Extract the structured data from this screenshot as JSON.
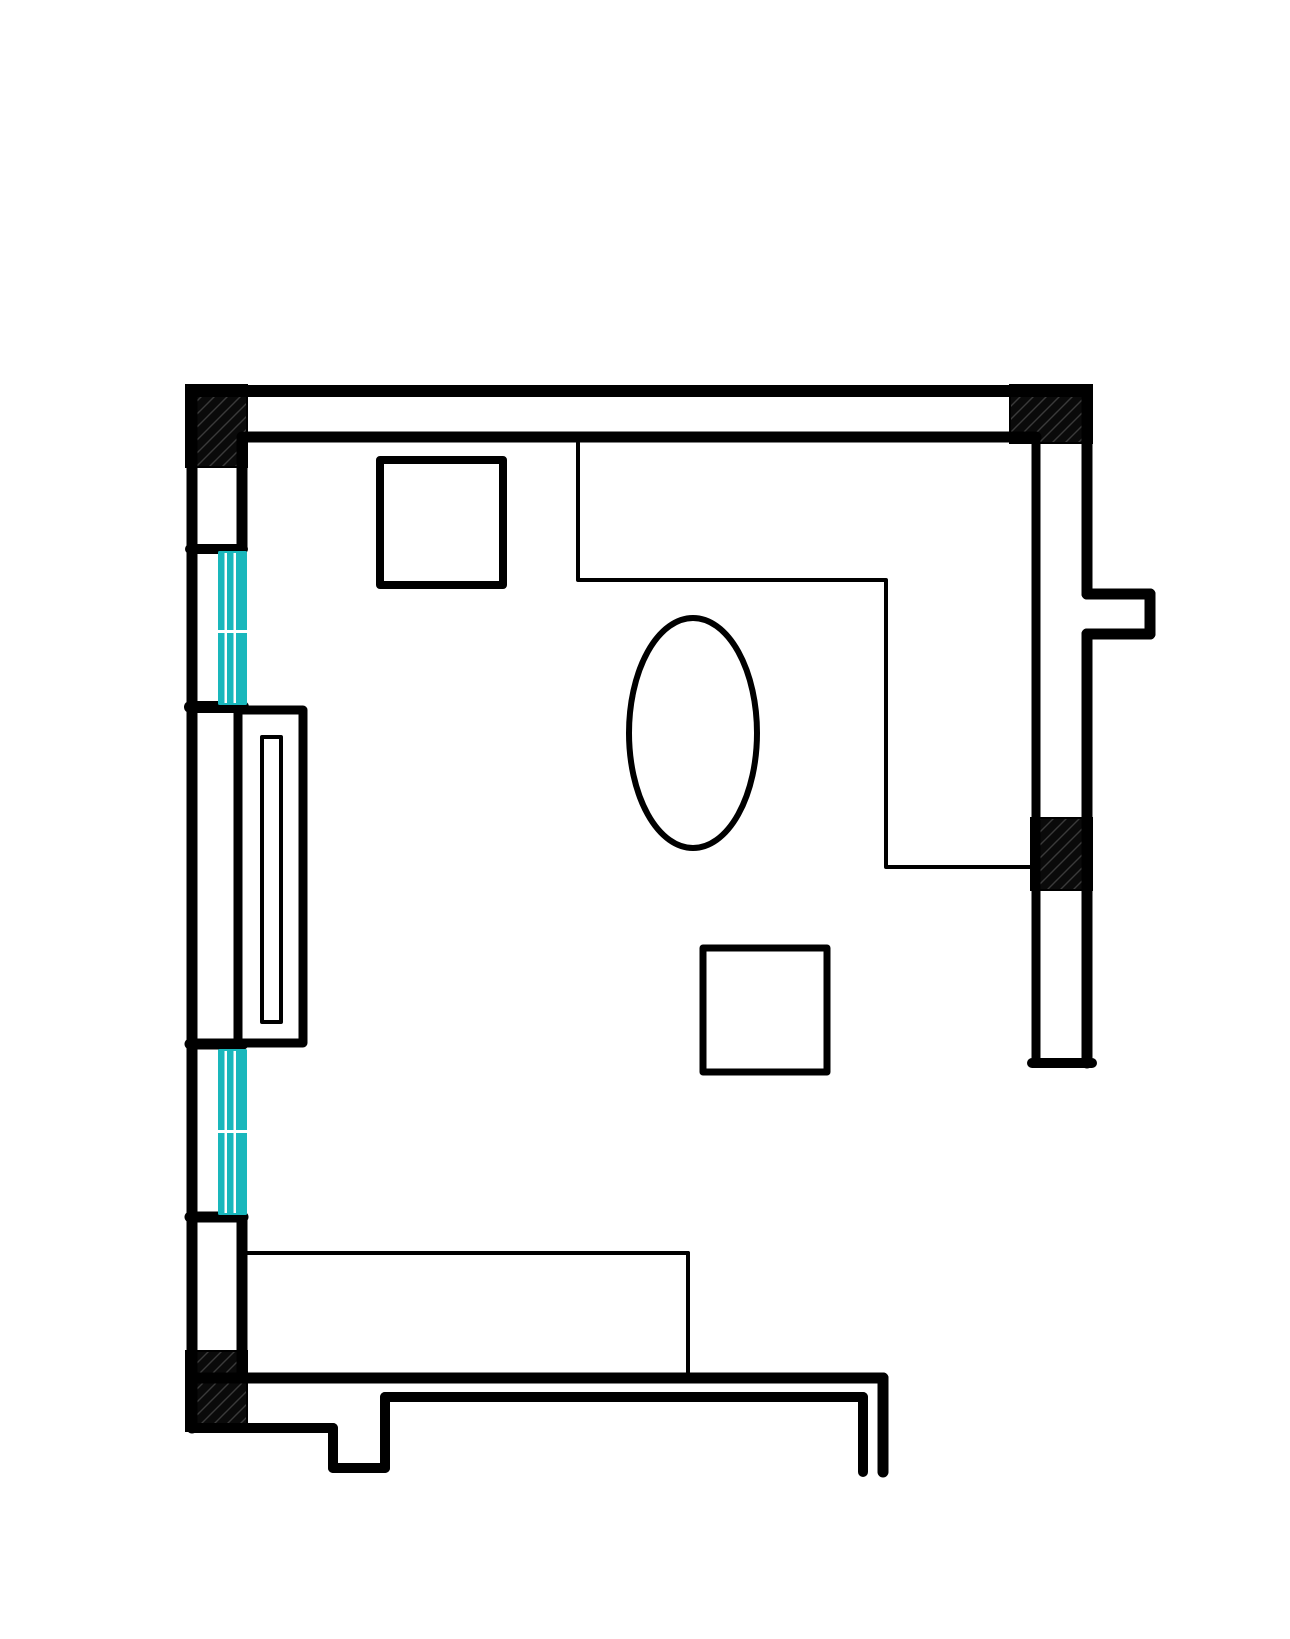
{
  "page": {
    "title": "Room floor plan drawing"
  },
  "canvas": {
    "width": 1290,
    "height": 1639,
    "background": "#ffffff"
  },
  "colors": {
    "wall": "#000000",
    "window_glass": "#19b7bc",
    "window_mullion": "#ffffff",
    "hatch_fill": "#0a0a0a",
    "hatch_stroke": "#3a3a3a",
    "furniture_fill": "#ffffff"
  },
  "walls": {
    "lines": [
      {
        "name": "top-wall-outer",
        "x1": 192,
        "y1": 391,
        "x2": 1087,
        "y2": 391,
        "w": 12
      },
      {
        "name": "top-wall-inner",
        "x1": 247,
        "y1": 437,
        "x2": 1036,
        "y2": 437,
        "w": 11
      },
      {
        "name": "left-wall-outer",
        "x1": 192,
        "y1": 391,
        "x2": 192,
        "y2": 1428,
        "w": 11
      },
      {
        "name": "left-wall-inner-upper",
        "x1": 242,
        "y1": 437,
        "x2": 242,
        "y2": 549,
        "w": 11
      },
      {
        "name": "left-wall-cap-above-window-1",
        "x1": 190,
        "y1": 549,
        "x2": 243,
        "y2": 549,
        "w": 10
      },
      {
        "name": "left-wall-cap-below-window-1",
        "x1": 190,
        "y1": 707,
        "x2": 243,
        "y2": 707,
        "w": 12
      },
      {
        "name": "left-wall-inner-middle",
        "x1": 242,
        "y1": 707,
        "x2": 242,
        "y2": 1044,
        "w": 11
      },
      {
        "name": "left-wall-cap-above-window-2",
        "x1": 190,
        "y1": 1044,
        "x2": 243,
        "y2": 1044,
        "w": 11
      },
      {
        "name": "left-wall-cap-below-window-2",
        "x1": 190,
        "y1": 1217,
        "x2": 243,
        "y2": 1217,
        "w": 11
      },
      {
        "name": "left-wall-inner-lower",
        "x1": 242,
        "y1": 1217,
        "x2": 242,
        "y2": 1378,
        "w": 11
      },
      {
        "name": "right-wall-inner",
        "x1": 1036,
        "y1": 437,
        "x2": 1036,
        "y2": 1063,
        "w": 9
      },
      {
        "name": "right-wall-outer-upper",
        "x1": 1087,
        "y1": 391,
        "x2": 1087,
        "y2": 594,
        "w": 11
      },
      {
        "name": "right-wall-outer-lower",
        "x1": 1087,
        "y1": 634,
        "x2": 1087,
        "y2": 1063,
        "w": 11
      },
      {
        "name": "right-wall-end-cap",
        "x1": 1032,
        "y1": 1063,
        "x2": 1092,
        "y2": 1063,
        "w": 10
      },
      {
        "name": "right-pier-top",
        "x1": 1087,
        "y1": 594,
        "x2": 1150,
        "y2": 594,
        "w": 11
      },
      {
        "name": "right-pier-right",
        "x1": 1150,
        "y1": 594,
        "x2": 1150,
        "y2": 634,
        "w": 11
      },
      {
        "name": "right-pier-bottom",
        "x1": 1150,
        "y1": 634,
        "x2": 1087,
        "y2": 634,
        "w": 11
      },
      {
        "name": "bottom-wall-top",
        "x1": 192,
        "y1": 1378,
        "x2": 883,
        "y2": 1378,
        "w": 11
      },
      {
        "name": "bottom-wall-inner",
        "x1": 385,
        "y1": 1397,
        "x2": 863,
        "y2": 1397,
        "w": 10
      },
      {
        "name": "bottom-wall-outer-left",
        "x1": 192,
        "y1": 1428,
        "x2": 333,
        "y2": 1428,
        "w": 10
      },
      {
        "name": "bottom-notch-left",
        "x1": 333,
        "y1": 1428,
        "x2": 333,
        "y2": 1468,
        "w": 10
      },
      {
        "name": "bottom-notch-bottom",
        "x1": 333,
        "y1": 1468,
        "x2": 385,
        "y2": 1468,
        "w": 10
      },
      {
        "name": "bottom-notch-right",
        "x1": 385,
        "y1": 1468,
        "x2": 385,
        "y2": 1397,
        "w": 10
      },
      {
        "name": "bottom-right-stub-outer",
        "x1": 883,
        "y1": 1378,
        "x2": 883,
        "y2": 1472,
        "w": 11
      },
      {
        "name": "bottom-right-stub-inner",
        "x1": 863,
        "y1": 1397,
        "x2": 863,
        "y2": 1472,
        "w": 10
      }
    ]
  },
  "hatch_blocks": [
    {
      "name": "corner-block-top-left",
      "x": 186,
      "y": 385,
      "w": 61,
      "h": 82
    },
    {
      "name": "corner-block-top-right",
      "x": 1010,
      "y": 385,
      "w": 82,
      "h": 58
    },
    {
      "name": "pier-block-right-wall",
      "x": 1031,
      "y": 818,
      "w": 61,
      "h": 72
    },
    {
      "name": "corner-block-bottom-left",
      "x": 186,
      "y": 1351,
      "w": 61,
      "h": 80
    }
  ],
  "windows": [
    {
      "name": "window-1",
      "x": 218,
      "y": 551,
      "w": 29,
      "h": 154,
      "seam_y": 630,
      "mullions": [
        224.5,
        233.5
      ],
      "mullion_w": 2.5,
      "seam_h": 3
    },
    {
      "name": "window-2",
      "x": 218,
      "y": 1049,
      "w": 29,
      "h": 166,
      "seam_y": 1130,
      "mullions": [
        224.5,
        233.5
      ],
      "mullion_w": 2.5,
      "seam_h": 3
    }
  ],
  "furniture": {
    "rects": [
      {
        "name": "square-table-top-left",
        "x": 380,
        "y": 460,
        "w": 123,
        "h": 125,
        "sw": 8
      },
      {
        "name": "square-table-center",
        "x": 703,
        "y": 948,
        "w": 124,
        "h": 124,
        "sw": 7
      },
      {
        "name": "wall-cabinet-outer",
        "x": 238,
        "y": 710,
        "w": 65,
        "h": 333,
        "sw": 9
      },
      {
        "name": "wall-cabinet-slot",
        "x": 262,
        "y": 737,
        "w": 19,
        "h": 285,
        "sw": 4
      }
    ],
    "polylines": [
      {
        "name": "l-shaped-counter",
        "points": [
          [
            578,
            443
          ],
          [
            578,
            580
          ],
          [
            886,
            580
          ],
          [
            886,
            867
          ],
          [
            1034,
            867
          ]
        ],
        "sw": 4
      }
    ],
    "ellipses": [
      {
        "name": "oval-table",
        "cx": 693,
        "cy": 733,
        "rx": 64,
        "ry": 115,
        "sw": 6
      }
    ],
    "lines": [
      {
        "name": "bottom-sofa-top",
        "x1": 246,
        "y1": 1253,
        "x2": 688,
        "y2": 1253,
        "w": 4
      },
      {
        "name": "bottom-sofa-right",
        "x1": 688,
        "y1": 1253,
        "x2": 688,
        "y2": 1376,
        "w": 4
      }
    ]
  }
}
